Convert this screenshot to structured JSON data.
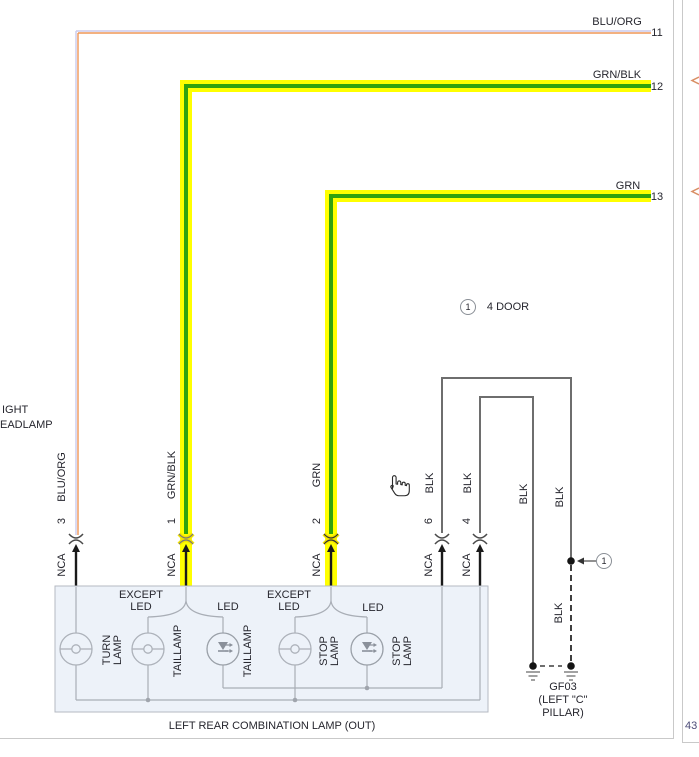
{
  "colors": {
    "highlight_yellow": "#ffff00",
    "wire_green": "#31a30e",
    "wire_orange": "#ef9757",
    "wire_blue": "#cbcaec",
    "wire_black": "#1a1a1a",
    "wire_gray": "#6e6e6e",
    "component_fill": "#edf2f9",
    "text": "#26262e"
  },
  "rows": [
    {
      "num": "11",
      "label": "BLU/ORG"
    },
    {
      "num": "12",
      "label": "GRN/BLK"
    },
    {
      "num": "13",
      "label": "GRN"
    }
  ],
  "vertical_labels": {
    "blu_org": "BLU/ORG",
    "grn_blk": "GRN/BLK",
    "grn": "GRN",
    "blk": "BLK",
    "nca": "NCA"
  },
  "pins": {
    "p3": "3",
    "p1": "1",
    "p2": "2",
    "p6": "6",
    "p4": "4"
  },
  "note": {
    "symbol": "1",
    "text": "4 DOOR"
  },
  "callout": {
    "symbol": "1"
  },
  "left_note": {
    "line1": "IGHT",
    "line2": "EADLAMP"
  },
  "component": {
    "title": "LEFT REAR COMBINATION LAMP (OUT)",
    "except_led": "EXCEPT\nLED",
    "led": "LED",
    "turn_lamp": "TURN\nLAMP",
    "taillamp": "TAILLAMP",
    "stop_lamp": "STOP\nLAMP"
  },
  "ground": {
    "id": "GF03",
    "loc1": "(LEFT \"C\"",
    "loc2": "PILLAR)"
  },
  "adjacent_page": {
    "number": "43"
  }
}
